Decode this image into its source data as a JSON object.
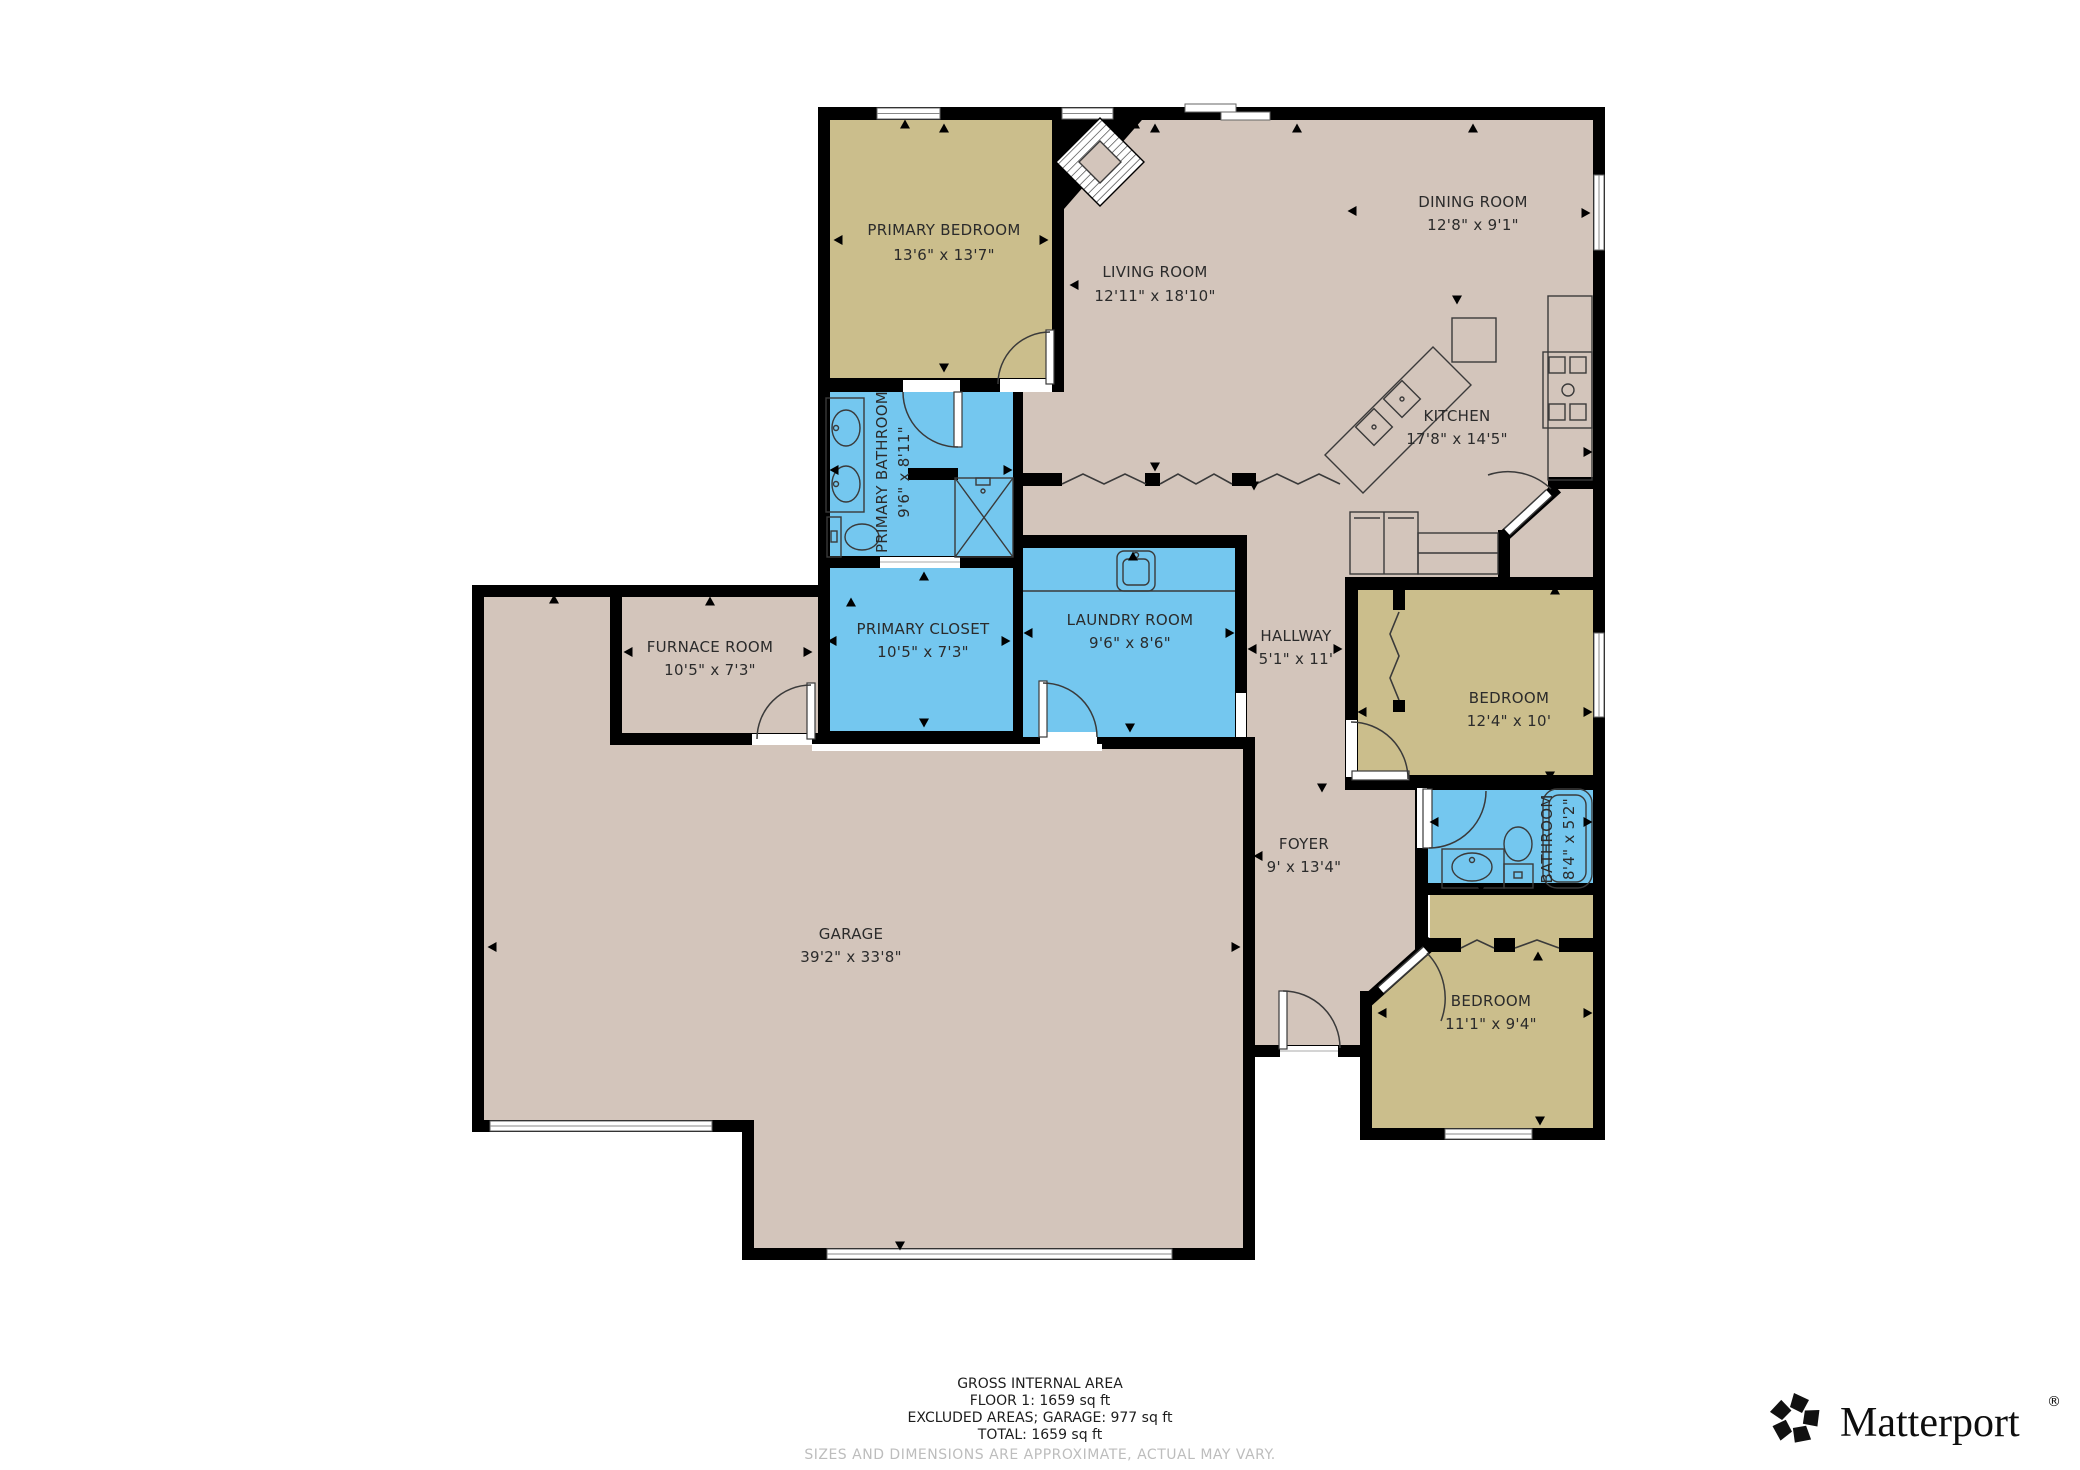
{
  "colors": {
    "floor": "#d3c5bb",
    "tan": "#cbbe8c",
    "wet": "#74c7ef",
    "wall": "#000000",
    "label": "#2b2b2b",
    "muted": "#bdbdbd"
  },
  "rooms": {
    "primary_bedroom": {
      "name": "PRIMARY BEDROOM",
      "dims": "13'6\" x 13'7\""
    },
    "living_room": {
      "name": "LIVING ROOM",
      "dims": "12'11\" x 18'10\""
    },
    "dining_room": {
      "name": "DINING ROOM",
      "dims": "12'8\" x 9'1\""
    },
    "kitchen": {
      "name": "KITCHEN",
      "dims": "17'8\" x 14'5\""
    },
    "primary_bathroom": {
      "name": "PRIMARY BATHROOM",
      "dims": "9'6\" x 8'11\""
    },
    "primary_closet": {
      "name": "PRIMARY CLOSET",
      "dims": "10'5\" x 7'3\""
    },
    "laundry_room": {
      "name": "LAUNDRY ROOM",
      "dims": "9'6\" x 8'6\""
    },
    "hallway": {
      "name": "HALLWAY",
      "dims": "5'1\" x 11'"
    },
    "furnace_room": {
      "name": "FURNACE ROOM",
      "dims": "10'5\" x 7'3\""
    },
    "bedroom_right": {
      "name": "BEDROOM",
      "dims": "12'4\" x 10'"
    },
    "bathroom": {
      "name": "BATHROOM",
      "dims": "8'4\" x 5'2\""
    },
    "bedroom_bottom": {
      "name": "BEDROOM",
      "dims": "11'1\" x 9'4\""
    },
    "foyer": {
      "name": "FOYER",
      "dims": "9' x 13'4\""
    },
    "garage": {
      "name": "GARAGE",
      "dims": "39'2\" x 33'8\""
    }
  },
  "footer": {
    "title": "GROSS INTERNAL AREA",
    "floor1": "FLOOR 1: 1659 sq ft",
    "excluded": "EXCLUDED AREAS; GARAGE: 977 sq ft",
    "total": "TOTAL: 1659 sq ft",
    "disclaimer": "SIZES AND DIMENSIONS ARE APPROXIMATE, ACTUAL MAY VARY."
  },
  "branding": {
    "logo_text": "Matterport",
    "registered_mark": "®"
  }
}
